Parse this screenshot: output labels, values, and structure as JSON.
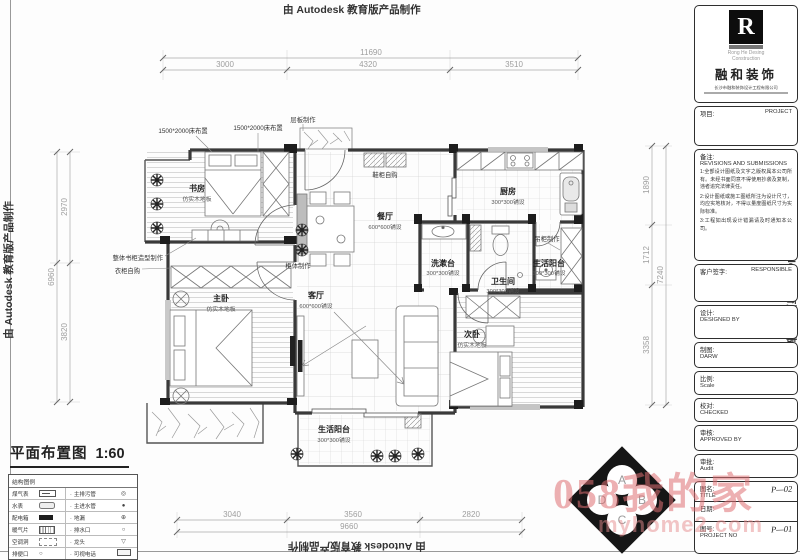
{
  "stamps": {
    "top": "由 Autodesk 教育版产品制作",
    "bottom": "由 Autodesk 教育版产品制作",
    "left": "由 Autodesk 教育版产品制作",
    "right": "由 Autodesk 教育版产品制作"
  },
  "plan_title": {
    "name": "平面布置图",
    "scale": "1:60"
  },
  "rooms": {
    "study": {
      "name": "书房",
      "floor": "仿实木地板"
    },
    "master": {
      "name": "主卧",
      "floor": "仿实木地板"
    },
    "second": {
      "name": "次卧",
      "floor": "仿实木地板"
    },
    "dining": {
      "name": "餐厅",
      "floor": "600*600铺设"
    },
    "living": {
      "name": "客厅",
      "floor": "600*600铺设"
    },
    "kitchen": {
      "name": "厨房",
      "floor": "300*300铺设"
    },
    "wash": {
      "name": "洗漱台",
      "floor": "300*300铺设"
    },
    "bath": {
      "name": "卫生间",
      "floor": "300*300铺设"
    },
    "balcony_side": {
      "name": "生活阳台",
      "floor": "300*300铺设"
    },
    "balcony_bottom": {
      "name": "生活阳台",
      "floor": "300*300铺设"
    }
  },
  "annotations": {
    "bed1": "1500*2000床布置",
    "bed2": "1500*2000床布置",
    "shelf": "层板制作",
    "shoe": "鞋柜自购",
    "bookcase": "整体书柜造型制作",
    "wardrobe": "衣柜自购",
    "cabinet": "柜体制作",
    "hanging": "吊柜制作"
  },
  "dimensions": {
    "top": {
      "segments": [
        "3000",
        "4320",
        "3510"
      ],
      "total": "11690"
    },
    "left": {
      "segments": [
        "2970",
        "3820"
      ],
      "total": "6960"
    },
    "right": {
      "segments": [
        "1890",
        "1712",
        "3358"
      ],
      "total": "7240"
    },
    "bottom": {
      "segments": [
        "3040",
        "3560",
        "2820"
      ],
      "total": "9660"
    }
  },
  "legend": {
    "header": "结构图例",
    "rows": [
      {
        "left": "煤气表",
        "right": "主排污管",
        "right_sym": "◎",
        "left_sym": ""
      },
      {
        "left": "水表",
        "right": "主进水管",
        "right_sym": "●",
        "left_sym": ""
      },
      {
        "left": "配电箱",
        "right": "地漏",
        "right_sym": "⊕",
        "left_sym": ""
      },
      {
        "left": "暖气片",
        "right": "排水口",
        "right_sym": "○",
        "left_sym": ""
      },
      {
        "left": "空调洞",
        "right": "龙头",
        "right_sym": "▽",
        "left_sym": ""
      },
      {
        "left": "排便口",
        "right": "可视电话",
        "right_sym": "",
        "left_sym": "○"
      }
    ]
  },
  "title_block": {
    "logo_letter": "R",
    "company_en_1": "Rong He Desing",
    "company_en_2": "Construction",
    "brand": "融和装饰",
    "company_cn": "长沙市融和装饰设计工程有限公司",
    "project": {
      "label": "项目:",
      "value": "PROJECT"
    },
    "remarks": {
      "label": "备注:",
      "subtitle": "REVISIONS AND SUBMISSIONS",
      "notes": [
        "1:全部设计图纸及文字之版权属本公司所有。未经书面同意不得使用抄袭及复制，违者追究法律责任。",
        "2:设计图纸或施工图纸所注为设计尺寸，均应实地核对，不得以量度图纸尺寸为实际标准。",
        "3:工程如出现设计错漏请及时通知本公司。"
      ]
    },
    "signature": {
      "label": "客户签字:",
      "value": "RESPONSIBLE"
    },
    "designed": {
      "label": "设计:",
      "value": "DESIGNED BY"
    },
    "drawn": {
      "label": "制图:",
      "value": "DARW"
    },
    "scale": {
      "label": "比例:",
      "value": "Scale"
    },
    "checked": {
      "label": "校对:",
      "value": "CHECKED"
    },
    "approved": {
      "label": "审核:",
      "value": "APPROVED BY"
    },
    "audit": {
      "label": "审批:",
      "value": "Audit"
    },
    "sheet": {
      "label": "图名:",
      "value": "TITLE",
      "number": "P—02"
    },
    "date": {
      "label": "日期:"
    },
    "project_no": {
      "label": "图号:",
      "value": "PROJECT NO",
      "number": "P—01"
    }
  },
  "compass": {
    "letters": [
      "A",
      "B",
      "C",
      "D"
    ]
  },
  "watermark": {
    "cn": "058我的家",
    "site": "myhome2.com"
  }
}
